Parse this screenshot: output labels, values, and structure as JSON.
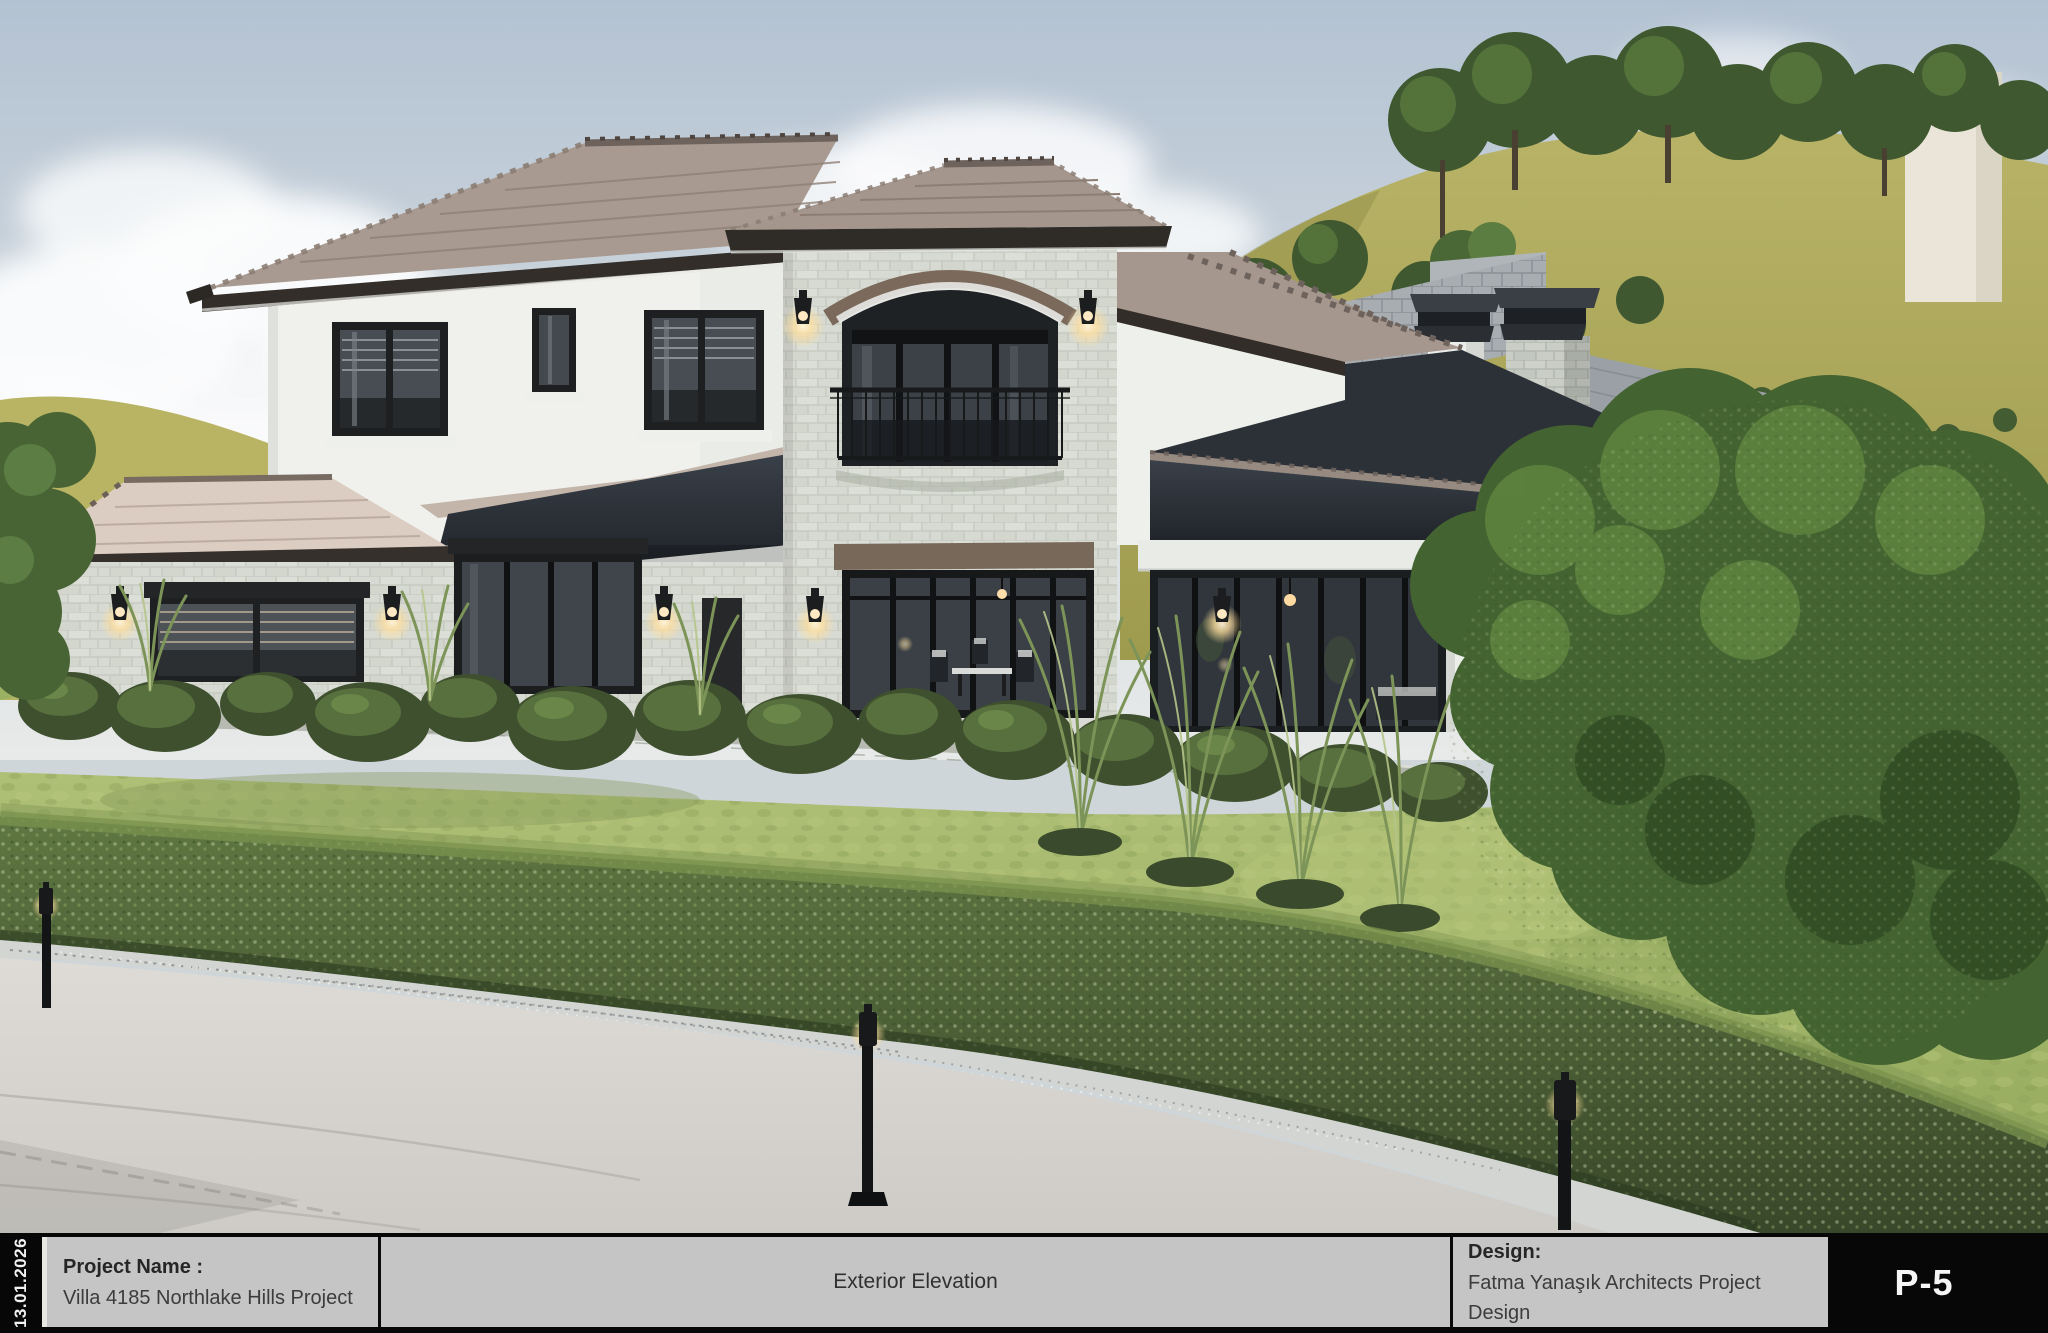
{
  "sheet": {
    "date_stamp": "13.01.2026",
    "page_number": "P-5",
    "title_block": {
      "project_label": "Project Name :",
      "project_value": "Villa 4185 Northlake Hills Project",
      "center_title": "Exterior Elevation",
      "design_label": "Design:",
      "design_value": "Fatma Yanaşık Architects Project Design"
    }
  },
  "palette": {
    "titleblock_gray": "#c5c5c5",
    "titleblock_black": "#070707",
    "sky_top": "#b3c2d2",
    "sky_horizon": "#e3e7e9",
    "hill_olive": "#aca75a",
    "roof_sunlit_tan": "#a4968c",
    "roof_shadow": "#2b2f36",
    "stone_wall": "#d7dad2",
    "stucco_white": "#f0f1ed",
    "window_frame_black": "#1c1e20",
    "arch_trim_brown": "#7b6a5c",
    "hedge_green": "#556b3b",
    "lawn_green": "#a7bb6e",
    "tree_green": "#436331",
    "driveway_gray": "#d9d6d1",
    "sconce_glow": "#ffdf9e"
  }
}
